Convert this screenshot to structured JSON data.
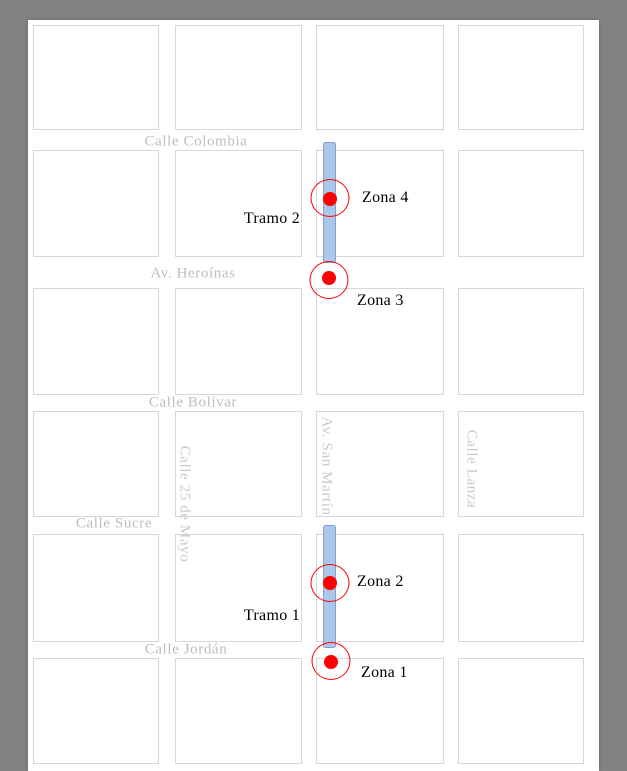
{
  "figure_title": "street-grid map with study segments and zones",
  "streets": {
    "horizontal": [
      {
        "name": "Calle Colombia"
      },
      {
        "name": "Av. Heroínas"
      },
      {
        "name": "Calle Bolívar"
      },
      {
        "name": "Calle Sucre"
      },
      {
        "name": "Calle Jordán"
      }
    ],
    "vertical": [
      {
        "name": "Calle 25 de Mayo"
      },
      {
        "name": "Av. San Martín"
      },
      {
        "name": "Calle Lanza"
      }
    ]
  },
  "segments": [
    {
      "label": "Tramo 1"
    },
    {
      "label": "Tramo 2"
    }
  ],
  "zones": [
    {
      "label": "Zona 1"
    },
    {
      "label": "Zona 2"
    },
    {
      "label": "Zona 3"
    },
    {
      "label": "Zona 4"
    }
  ],
  "colors": {
    "background": "#828282",
    "paper": "#ffffff",
    "block_border": "#d7d7d7",
    "street_label": "#bdbdbd",
    "street_label_vertical": "#c9c9c9",
    "segment_fill": "#abc8ea",
    "segment_border": "#7ea3cf",
    "marker_red": "#ff0000",
    "annotation_text": "#000000"
  }
}
